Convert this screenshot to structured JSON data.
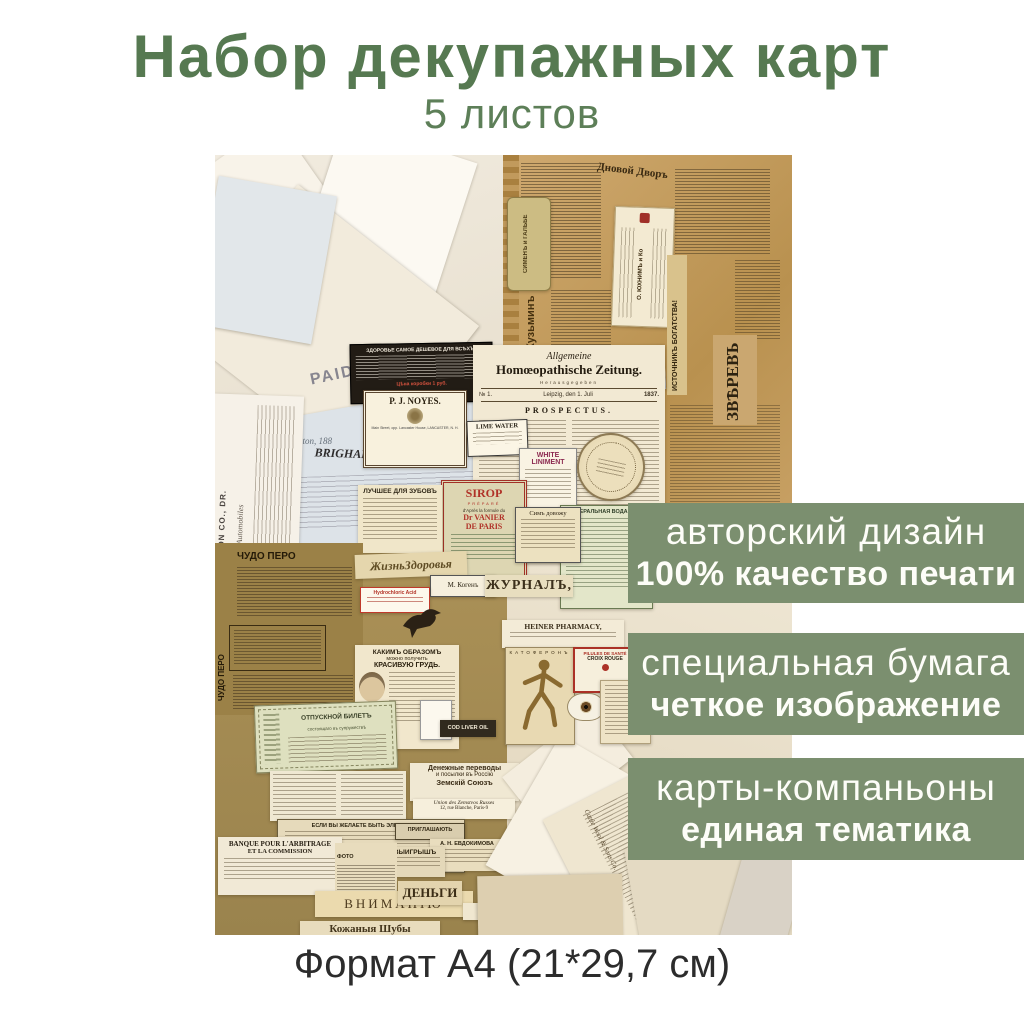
{
  "colors": {
    "title_green": "#567951",
    "banner_green": "#7b8f6f",
    "banner_text": "#fdfdf8",
    "footer_text": "#2c2c2c"
  },
  "header": {
    "title": "Набор декупажных карт",
    "subtitle": "5 листов"
  },
  "footer": {
    "format": "Формат А4 (21*29,7 см)"
  },
  "banners": [
    {
      "line1": "авторский дизайн",
      "line2": "100% качество печати"
    },
    {
      "line1": "специальная бумага",
      "line2": "четкое изображение"
    },
    {
      "line1": "карты-компаньоны",
      "line2": "единая тематика"
    }
  ],
  "collage": {
    "paid_stamp": "PAID",
    "brigham": "BRIGHAM, JONES & CO.",
    "brigham_script": "Boston, 188",
    "newton": "TO J. E. NEWTON CO., DR.",
    "newton_sub": "Automobiles",
    "black_ad_title": "ЗДОРОВЬЕ САМОЕ ДЕШЕВОЕ ДЛЯ ВСѢХЪ!",
    "black_ad_price": "Цѣна коробки 1 руб.",
    "zeitung_top": "Allgemeine",
    "zeitung_title": "Homœopathische Zeitung.",
    "zeitung_sub": "Herausgegeben",
    "zeitung_no": "№ 1.",
    "zeitung_city": "Leipzig, den 1. Juli",
    "zeitung_year": "1837.",
    "prospectus": "PROSPECTUS.",
    "noyes": "P. J. NOYES.",
    "noyes_sub": "Main Street, opp. Lancaster House, LANCASTER, N. H.",
    "lime_water": "LIME WATER",
    "liniment1": "WHITE",
    "liniment2": "LINIMENT",
    "sirop": "SIROP",
    "sirop_sub1": "PRÉPARÉ",
    "sirop_sub2": "d'Après la formule du",
    "sirop_name": "Dr VANIER",
    "sirop_city": "DE PARIS",
    "zubov": "ЛУЧШЕЕ ДЛЯ ЗУБОВЪ",
    "borjom": "МИНЕРАЛЬНАЯ ВОДА БОРЖ",
    "sim_dovozhu": "Симъ довожу",
    "vrach": "ВРАЧЪ",
    "dnovoi": "Дновой Дворъ",
    "kuzmin": "Кузьминъ",
    "galhbe": "СИМЕНЪ и ГАЛЬБЕ",
    "juhim": "О. ЮХНИМЪ и Ко",
    "istochnik": "ИСТОЧНИКЪ БОГАТСТВА!",
    "zverev": "ЗВѢРЕВЪ",
    "chudo_pero": "ЧУДО ПЕРО",
    "jizn": "ЖизньЗдоровья",
    "kogen": "М. Когенъ",
    "jurnal": "ЖУРНАЛЪ,",
    "acid": "Hydrochloric Acid",
    "grud1": "КАКИМЪ ОБРАЗОМЪ",
    "grud2": "можно получить",
    "grud3": "КРАСИВУЮ ГРУДЬ.",
    "ticket1": "ОТПУСКНОЙ БИЛЕТЪ",
    "ticket2": "состоящаго въ супружествѣ",
    "cod_liver": "COD LIVER OIL",
    "denper1": "Денежные переводы",
    "denper2": "и посылки въ Россію",
    "denper3": "Земскій Союзъ",
    "union1": "Union des Zemstvos Russes",
    "union2": "12, rue Blanche, Paris-9",
    "elegant": "ЕСЛИ ВЫ ЖЕЛАЕТЕ БЫТЬ ЭЛЕГАНТНЫМЪ",
    "masse": "N. MASSE",
    "priglash": "ПРИГЛАШАЮТЬ",
    "evdokimova": "А. Н. ЕВДОКИМОВА",
    "vyigrysh": "ВЫИГРЫШЪ",
    "banque1": "BANQUE POUR L'ARBITRAGE",
    "banque2": "ET LA COMMISSION",
    "foto": "ФОТО",
    "vnimaniyu": "ВНИМАНІЮ",
    "dengi": "ДЕНЬГИ",
    "max": "M A X",
    "shuby": "Кожаныя Шубы",
    "heiner": "HEINER PHARMACY,",
    "katoferon": "КАТОФЕРОНЪ",
    "pilules1": "PILULES DE SANTÉ",
    "pilules2": "CROIX ROUGE",
    "cattle": "Cattle Wool & Sons Co."
  }
}
